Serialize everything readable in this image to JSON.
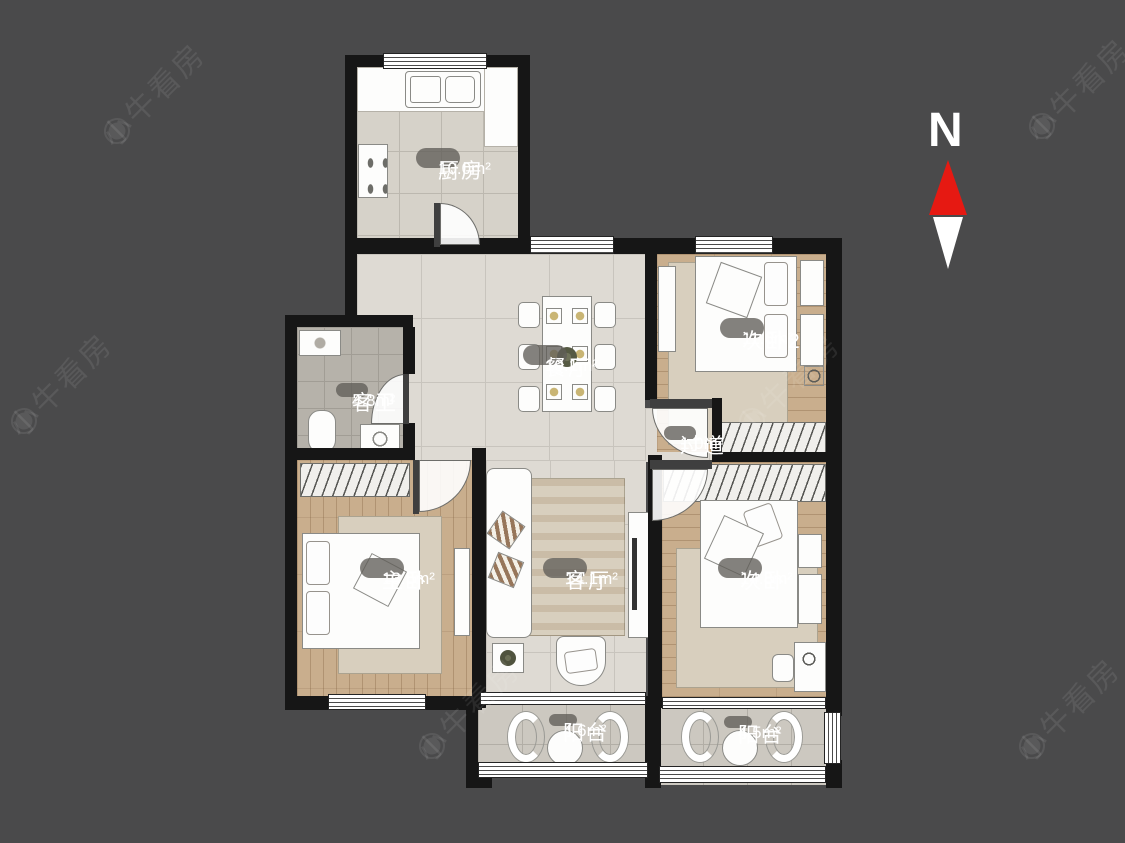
{
  "watermark": {
    "text": "小牛看房",
    "icon": "◉"
  },
  "compass": {
    "label": "N"
  },
  "rooms": [
    {
      "name": "厨房",
      "area": "10.0m²"
    },
    {
      "name": "餐厅",
      "area": "19.1m²"
    },
    {
      "name": "次卧2",
      "area": "11.6m²"
    },
    {
      "name": "客卫",
      "area": "4.8m²"
    },
    {
      "name": "过道",
      "area": "1.0m²"
    },
    {
      "name": "主卧",
      "area": "13.5m²"
    },
    {
      "name": "客厅",
      "area": "14.1m²"
    },
    {
      "name": "次卧",
      "area": "14.8m²"
    },
    {
      "name": "阳台",
      "area": "4.6m²"
    },
    {
      "name": "阳台",
      "area": "4.5m²"
    }
  ],
  "colors": {
    "background": "#4a4a4b",
    "wall": "#161616",
    "north_arrow_red": "#e61912",
    "label_pill": "rgba(96,93,89,0.78)"
  }
}
